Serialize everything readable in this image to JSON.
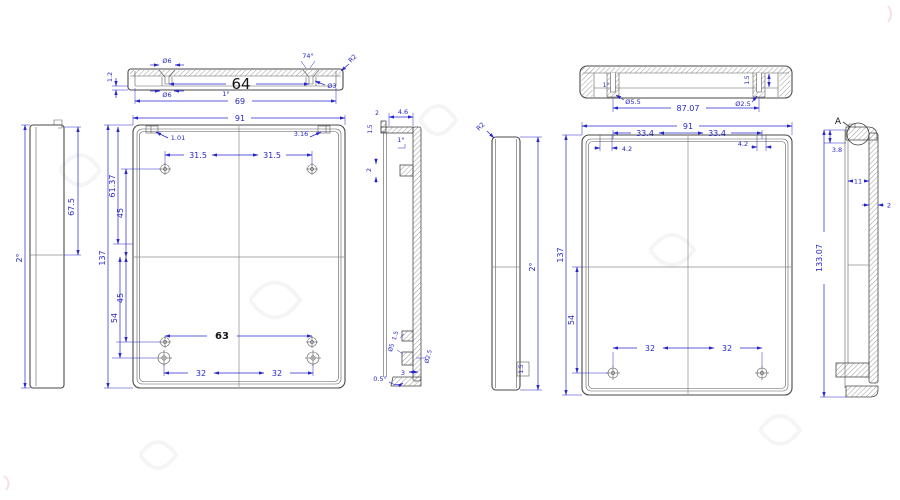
{
  "drawing_title": "enclosure-multiview-technical-drawing",
  "colors": {
    "dimension": "#2626cc",
    "outline": "#4a4a4a",
    "hatch": "#9a9a9a",
    "dark_text": "#141414"
  },
  "views": {
    "left_profile": {
      "draft_angle": "2°",
      "upper_height": "67.5"
    },
    "top_section_left": {
      "floor_thickness": "1.2",
      "cs_dia_top": "Ø6",
      "cs_dia_bottom": "Ø6",
      "hole_spacing": "64",
      "cs_angle": "74°",
      "hole_dia": "Ø3",
      "corner_radius": "R2",
      "draft_angle": "1°",
      "inner_width": "69"
    },
    "front_left": {
      "overall_width": "91",
      "clip_left": "1.01",
      "clip_right": "3.16",
      "hole_dx_left": "31.5",
      "hole_dx_right": "31.5",
      "upper_height": "61.37",
      "mid_upper": "45",
      "overall_height": "137",
      "mid_lower": "45",
      "lower_height": "54",
      "boss_spacing": "63",
      "bottom_dx_left": "32",
      "bottom_dx_right": "32"
    },
    "section_mid": {
      "flange_width": "4.6",
      "lip_width": "2",
      "lip_height": "1.5",
      "draft_angle": "1°",
      "rib_thickness": "2",
      "boss_dim_a": "1.5",
      "boss_dim_b": "Ø5",
      "boss_dim_c": "Ø2.5",
      "boss_height": "3",
      "floor_draft": "0.5°"
    },
    "right_profile": {
      "corner_radius": "R2",
      "draft_angle": "2°",
      "boss_label": "1.5"
    },
    "top_section_right": {
      "draft_angle": "1°",
      "boss_dia": "Ø5.5",
      "boss_spacing": "87.07",
      "hole_dia": "Ø2.5",
      "hole_depth": "1.5"
    },
    "front_right": {
      "overall_width": "91",
      "hole_dx_left": "33.4",
      "hole_dx_right": "33.4",
      "clip_left": "4.2",
      "clip_right": "4.2",
      "overall_height": "137",
      "lower_height": "54",
      "bottom_dx_left": "32",
      "bottom_dx_right": "32"
    },
    "right_section": {
      "detail_label": "A",
      "cap_height": "3.8",
      "inner_width": "11",
      "wall_thickness": "2",
      "overall_height": "133.07"
    }
  }
}
